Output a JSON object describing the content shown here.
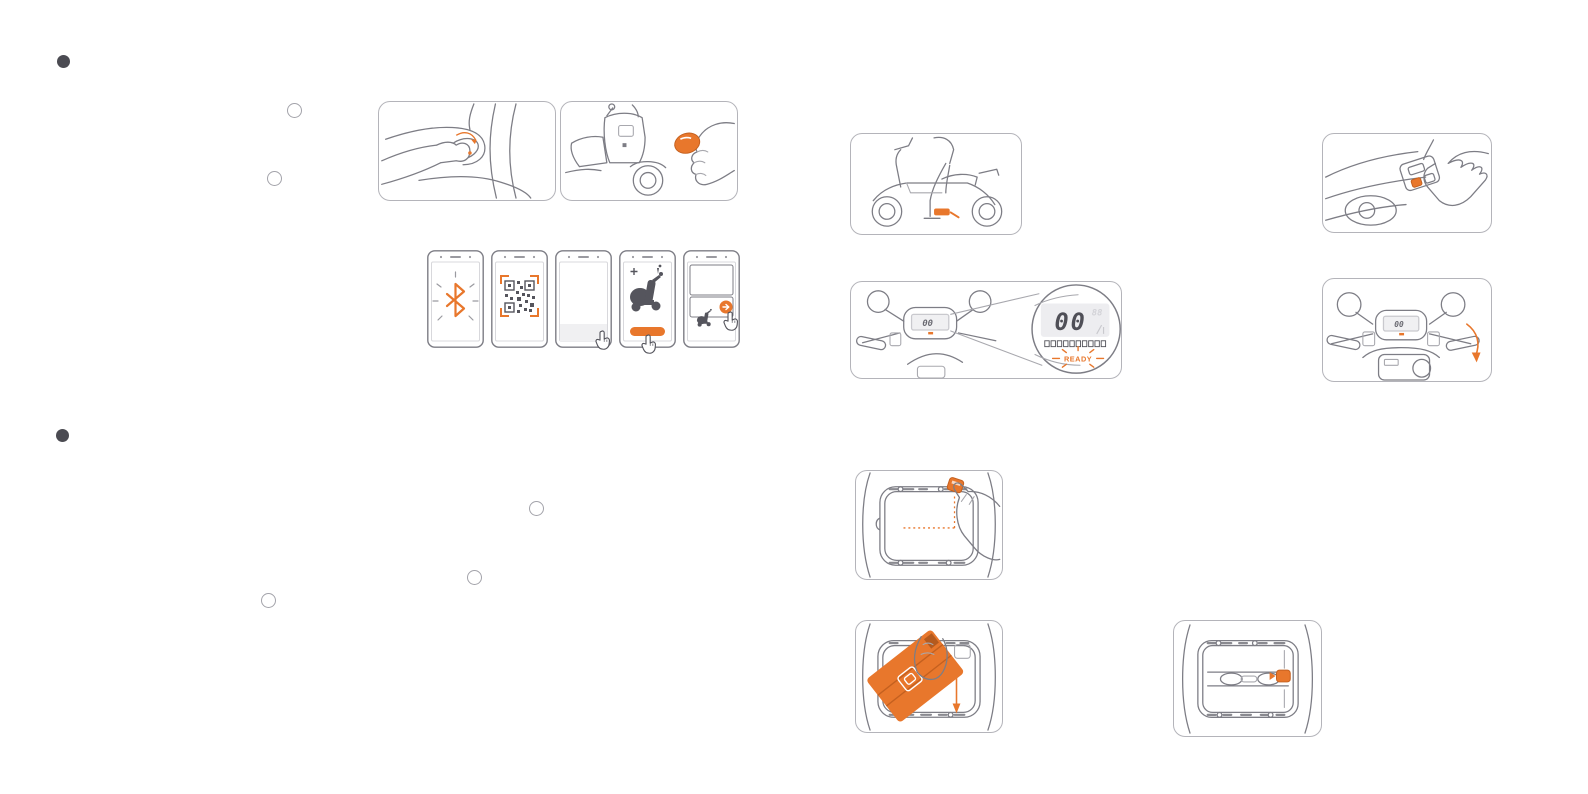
{
  "page": {
    "background": "#ffffff",
    "accent_color": "#e8772c",
    "line_color": "#7d7d85",
    "dark_color": "#4f4f57",
    "panel_border_color": "#b4b4ba"
  },
  "sections": [
    {
      "id": "section-1",
      "marker_style": "filled-dot"
    },
    {
      "id": "section-2",
      "marker_style": "filled-dot"
    }
  ],
  "step_markers": [
    {
      "id": "step-circle-1"
    },
    {
      "id": "step-circle-2"
    },
    {
      "id": "step-circle-3"
    },
    {
      "id": "step-circle-4"
    },
    {
      "id": "step-circle-5"
    }
  ],
  "dashboard_magnified": {
    "speed": "00",
    "ghost_segments": "88",
    "battery_segment_count": 10,
    "ready_label": "READY"
  },
  "mini_dashboard": {
    "speed": "00"
  },
  "figures": [
    {
      "id": "seat-latch-open",
      "icons": [
        "hand",
        "seat-latch",
        "orange-turn-arrow"
      ]
    },
    {
      "id": "fob-unlock",
      "icons": [
        "scooter-front",
        "hand",
        "orange-fob-disc"
      ]
    },
    {
      "id": "phone-bluetooth",
      "icons": [
        "bluetooth-icon"
      ]
    },
    {
      "id": "phone-qr-scan",
      "icons": [
        "qr-code",
        "orange-scan-brackets"
      ]
    },
    {
      "id": "phone-blank-tap",
      "icons": [
        "tap-hand-cursor"
      ]
    },
    {
      "id": "phone-scooter-confirm",
      "icons": [
        "scooter-silhouette",
        "orange-pill-button",
        "tap-hand-cursor"
      ]
    },
    {
      "id": "phone-device-list",
      "icons": [
        "scooter-thumbnail",
        "orange-circle-arrow-button",
        "tap-hand-cursor"
      ]
    },
    {
      "id": "rider-mount",
      "icons": [
        "scooter-side-view",
        "rider",
        "orange-kickstand-highlight"
      ]
    },
    {
      "id": "press-pod-button",
      "icons": [
        "handlebar-top-view",
        "hand",
        "orange-button"
      ]
    },
    {
      "id": "dashboard-ready",
      "icons": [
        "handlebar-front-view",
        "magnifier-circle",
        "lcd-display"
      ]
    },
    {
      "id": "throttle-twist",
      "icons": [
        "handlebar-front-view",
        "orange-twist-arrow"
      ]
    },
    {
      "id": "unplug-connector",
      "icons": [
        "battery-bay-top-view",
        "hand",
        "orange-connector",
        "orange-dotted-path"
      ]
    },
    {
      "id": "remove-battery",
      "icons": [
        "battery-bay-top-view",
        "orange-battery-pack",
        "hand",
        "orange-down-arrow"
      ]
    },
    {
      "id": "empty-bay",
      "icons": [
        "battery-bay-top-view",
        "orange-connector"
      ]
    }
  ]
}
